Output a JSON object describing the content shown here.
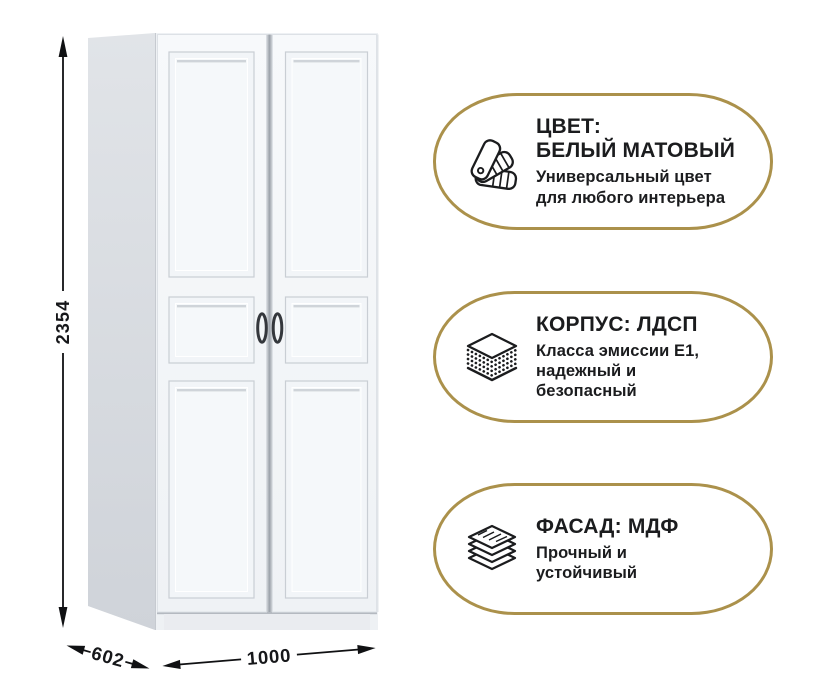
{
  "product": {
    "dimensions": {
      "height_mm": "2354",
      "depth_mm": "602",
      "width_mm": "1000"
    }
  },
  "badges": [
    {
      "icon": "swatch-fan-icon",
      "title": "ЦВЕТ:\nБЕЛЫЙ МАТОВЫЙ",
      "description": "Универсальный цвет\nдля любого интерьера"
    },
    {
      "icon": "chipboard-layers-icon",
      "title": "КОРПУС: ЛДСП",
      "description": "Класса эмиссии Е1,\nнадежный и\nбезопасный"
    },
    {
      "icon": "mdf-stack-icon",
      "title": "ФАСАД: МДФ",
      "description": "Прочный и\nустойчивый"
    }
  ],
  "colors": {
    "accent_gold": "#AB914B",
    "text_dark": "#1B1C1E",
    "wardrobe_front": "#F4F6F9",
    "wardrobe_side": "#D6D9DE"
  }
}
